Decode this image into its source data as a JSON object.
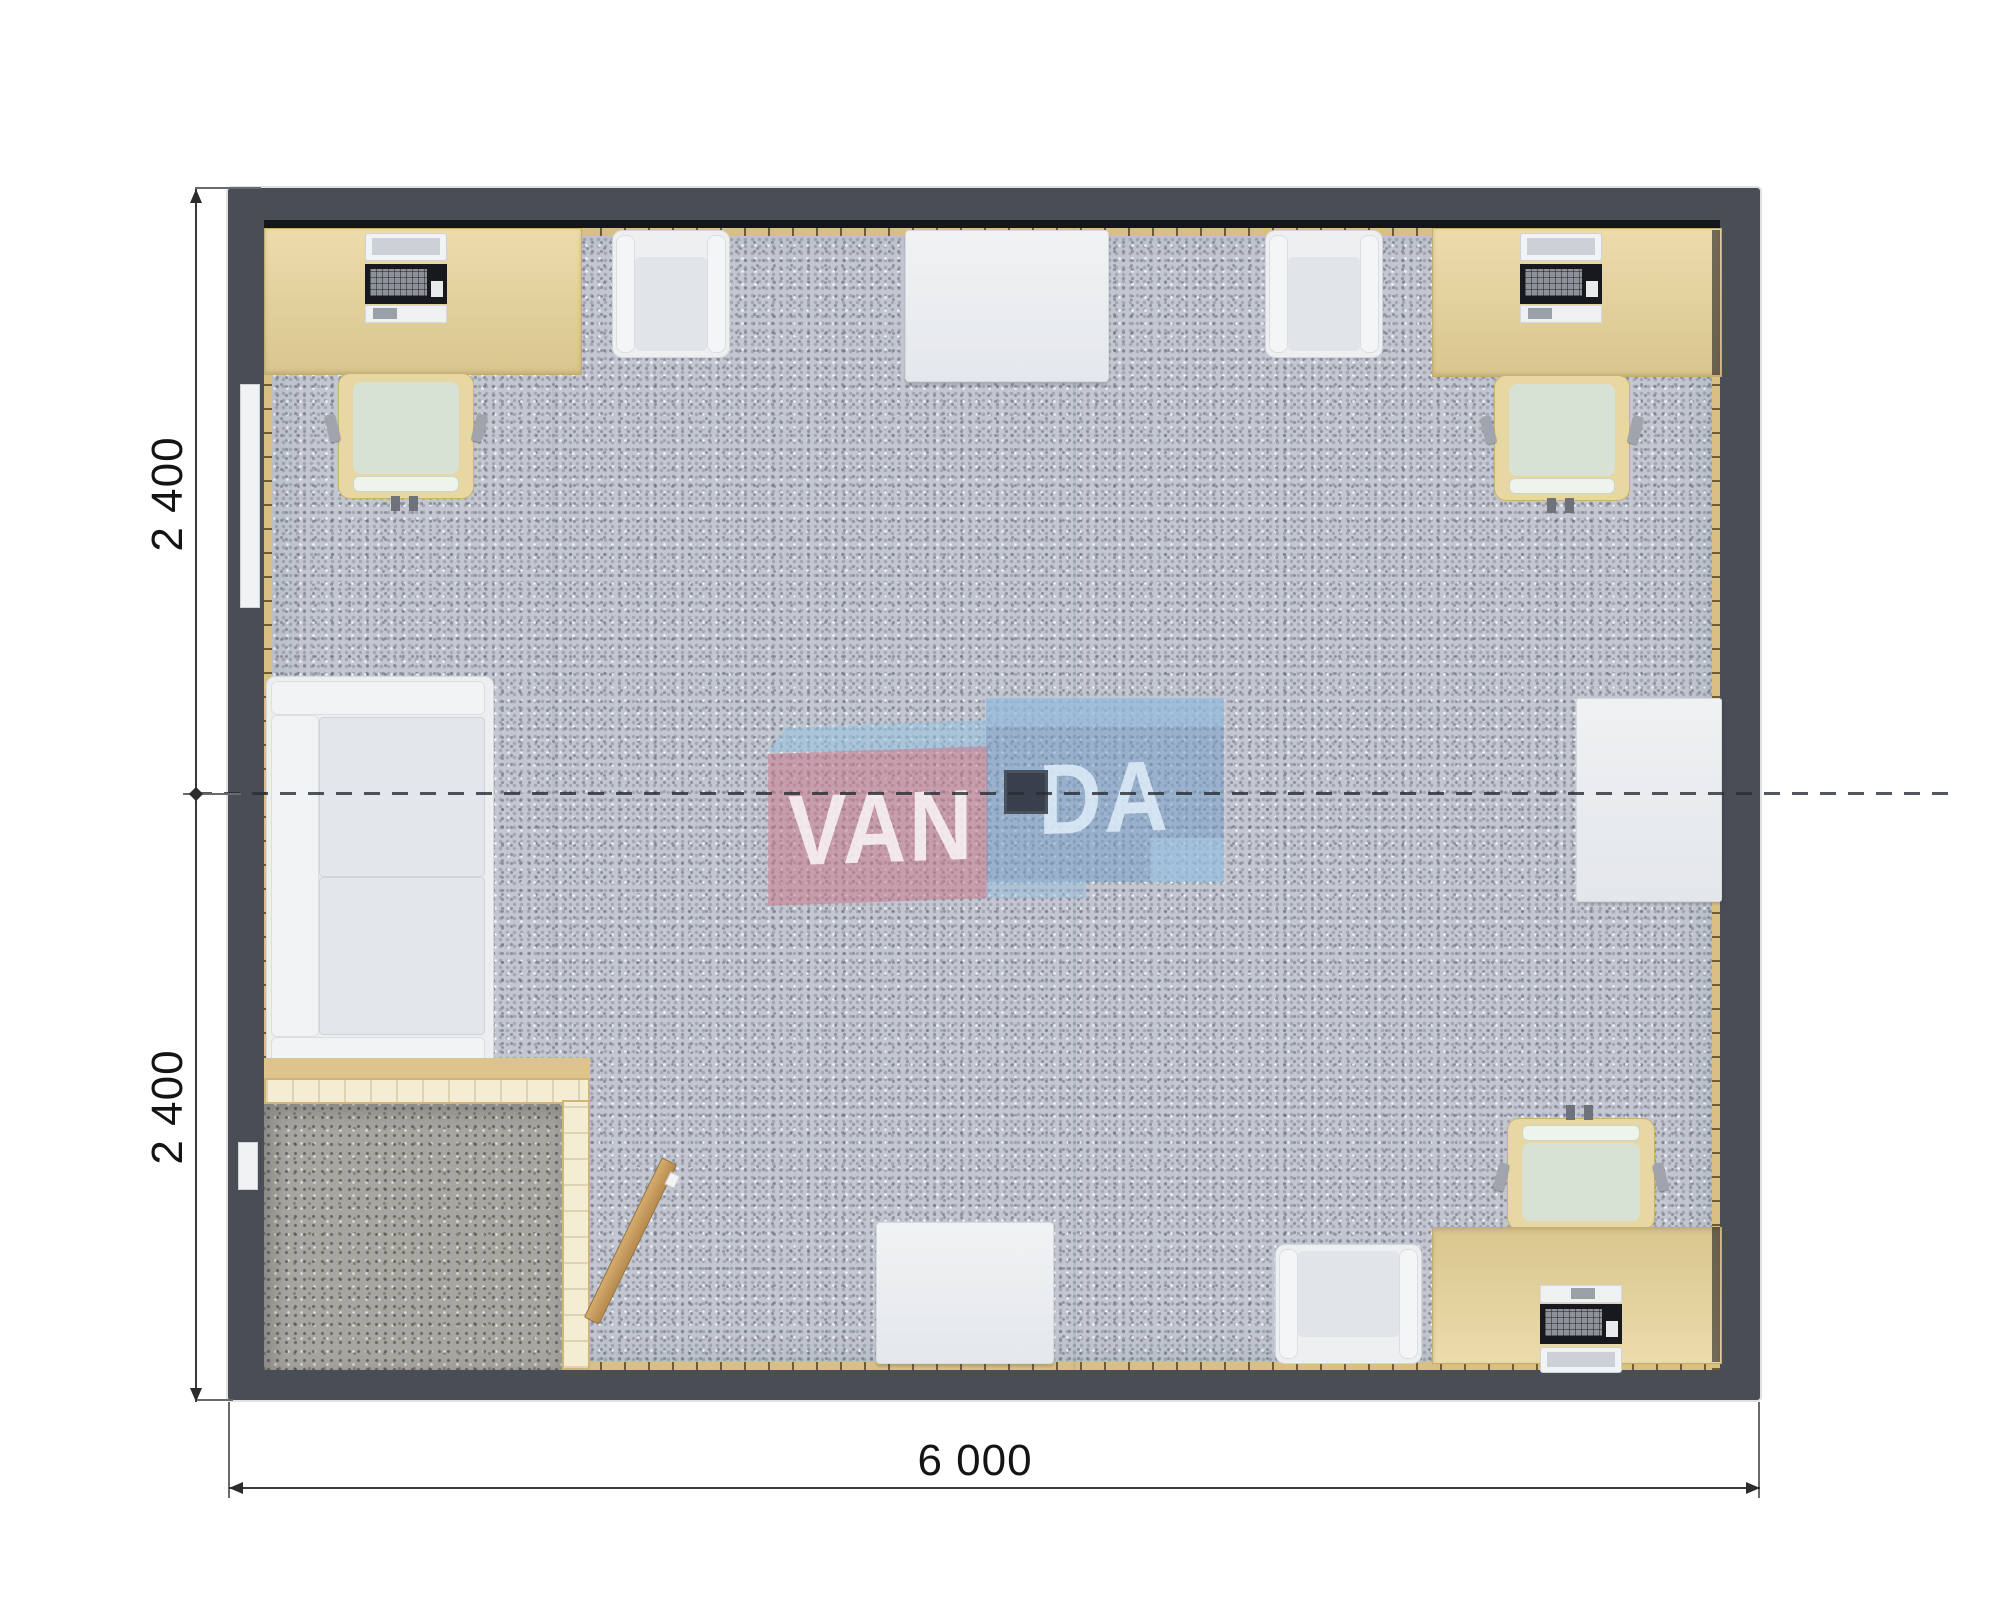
{
  "drawing": {
    "dimensions": {
      "left_upper": "2 400",
      "left_lower": "2 400",
      "bottom_width": "6 000"
    },
    "watermark": {
      "brand": "VANDA",
      "left": "VAN",
      "right": "DA"
    },
    "colors": {
      "wall": "#484d56",
      "carpet": "#c3c7d1",
      "vestibule_floor": "#a8a6a1",
      "desk": "#e2d09b",
      "chair_seat": "#d8e2d4",
      "partition": "#f5edd3",
      "door_wood": "#c79e61",
      "white_furniture": "#eceef0",
      "watermark_pink": "#cd8093",
      "watermark_blue": "#7fa3cc",
      "dimension_line": "#3a3a3a"
    }
  }
}
